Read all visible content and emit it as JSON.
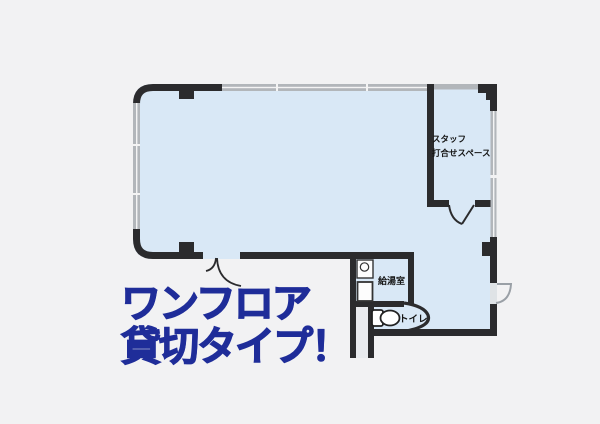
{
  "floor_plan": {
    "labels": {
      "staff_room_line1": "スタッフ",
      "staff_room_line2": "打合せスペース",
      "kitchenette": "給湯室",
      "toilet": "トイレ"
    },
    "icons": {
      "toilet": "toilet-icon",
      "sink_counter": "sink-counter-icon",
      "doors": [
        "entrance-double-door-arc",
        "staff-room-door-arc",
        "toilet-door-arc",
        "exit-door-arc"
      ]
    },
    "colors": {
      "background": "#f2f2f3",
      "floor": "#d9e8f6",
      "wall": "#2b2b2d",
      "window": "#b2b6ba",
      "corridor": "#e9ebee"
    }
  },
  "headline": {
    "line1": "ワンフロア",
    "line2": "貸切タイプ！",
    "color": "#1f2d99"
  }
}
